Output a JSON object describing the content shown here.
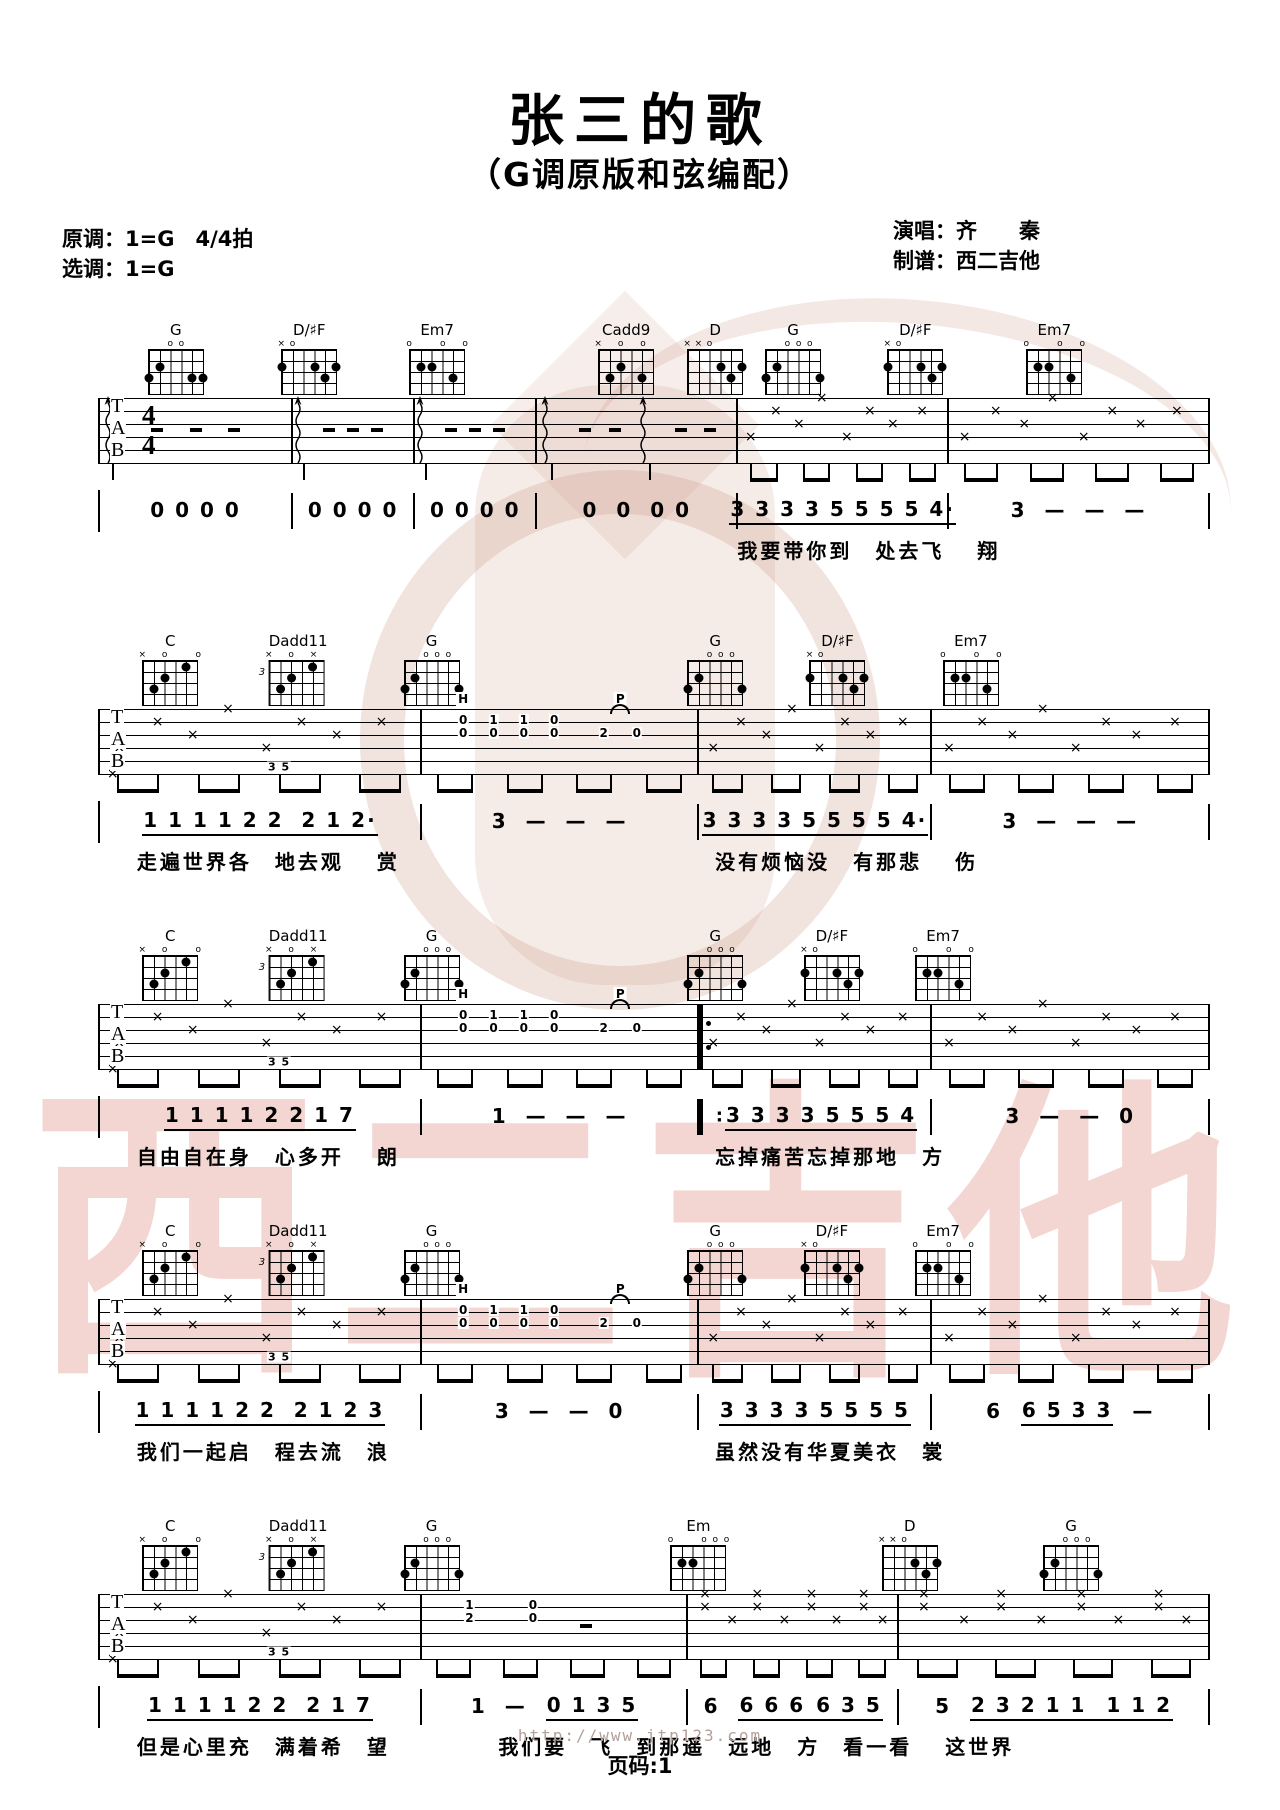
{
  "page": {
    "title": "张三的歌",
    "subtitle": "（G调原版和弦编配）"
  },
  "meta": {
    "original_key": "原调：1=G",
    "time_signature_label": "4/4拍",
    "time_signature": "4/4",
    "selected_key": "选调：1=G",
    "singer": "演唱：齐　　秦",
    "tabber": "制谱：西二吉他"
  },
  "watermark": {
    "text": "西二吉他"
  },
  "footer": {
    "url": "http://www.jtp123.com",
    "page_label": "页码:1"
  },
  "licks": {
    "hammer_label": "H",
    "pull_label": "P",
    "top_row": [
      "0",
      "1",
      "1",
      "0"
    ],
    "mid_row": [
      "0",
      "0",
      "0",
      "0"
    ],
    "pull_notes": [
      "2",
      "0"
    ],
    "bass_run": "3 5",
    "box_rows": [
      [
        "1",
        "0"
      ],
      [
        "2",
        "0"
      ]
    ]
  },
  "chord_shapes": {
    "G_a": {
      "name": "G",
      "top": [
        "",
        "",
        "o",
        "o",
        "",
        ""
      ],
      "dots": [
        [
          0,
          3
        ],
        [
          1,
          2
        ],
        [
          4,
          3
        ],
        [
          5,
          3
        ]
      ]
    },
    "G_b": {
      "name": "G",
      "top": [
        "",
        "",
        "o",
        "o",
        "o",
        ""
      ],
      "dots": [
        [
          0,
          3
        ],
        [
          1,
          2
        ],
        [
          5,
          3
        ]
      ]
    },
    "DsF": {
      "name": "D/♯F",
      "top": [
        "×",
        "o",
        "",
        "",
        "",
        ""
      ],
      "dots": [
        [
          0,
          2
        ],
        [
          3,
          2
        ],
        [
          4,
          3
        ],
        [
          5,
          2
        ]
      ]
    },
    "Em7": {
      "name": "Em7",
      "top": [
        "o",
        "",
        "",
        "o",
        "",
        "o"
      ],
      "dots": [
        [
          1,
          2
        ],
        [
          2,
          2
        ],
        [
          4,
          3
        ]
      ]
    },
    "Cadd9": {
      "name": "Cadd9",
      "top": [
        "×",
        "",
        "o",
        "",
        "o",
        ""
      ],
      "dots": [
        [
          1,
          3
        ],
        [
          2,
          2
        ],
        [
          4,
          3
        ]
      ]
    },
    "D": {
      "name": "D",
      "top": [
        "×",
        "×",
        "o",
        "",
        "",
        ""
      ],
      "dots": [
        [
          3,
          2
        ],
        [
          4,
          3
        ],
        [
          5,
          2
        ]
      ]
    },
    "C": {
      "name": "C",
      "top": [
        "×",
        "",
        "o",
        "",
        "",
        "o"
      ],
      "dots": [
        [
          1,
          3
        ],
        [
          2,
          2
        ],
        [
          4,
          1
        ]
      ]
    },
    "Dadd11": {
      "name": "Dadd11",
      "top": [
        "×",
        "",
        "o",
        "",
        "×",
        ""
      ],
      "dots": [
        [
          1,
          3
        ],
        [
          2,
          2
        ],
        [
          4,
          1
        ]
      ],
      "fret": "3"
    },
    "Em": {
      "name": "Em",
      "top": [
        "o",
        "",
        "",
        "o",
        "o",
        "o"
      ],
      "dots": [
        [
          1,
          2
        ],
        [
          2,
          2
        ]
      ]
    }
  },
  "systems": [
    {
      "ts": true,
      "chords": [
        {
          "s": "G_a",
          "x": 7
        },
        {
          "s": "DsF",
          "x": 19
        },
        {
          "s": "Em7",
          "x": 30.5
        },
        {
          "s": "Cadd9",
          "x": 47.5
        },
        {
          "s": "D",
          "x": 55.5
        },
        {
          "s": "G_b",
          "x": 62.5
        },
        {
          "s": "DsF",
          "x": 73.5
        },
        {
          "s": "Em7",
          "x": 86
        }
      ],
      "measures": [
        {
          "w": 17.4,
          "k": "strum"
        },
        {
          "w": 11,
          "k": "strum"
        },
        {
          "w": 11,
          "k": "strum"
        },
        {
          "w": 18.1,
          "k": "strum2"
        },
        {
          "w": 19,
          "k": "x"
        },
        {
          "w": 23.5,
          "k": "x"
        }
      ],
      "jianpu": [
        {
          "w": 17.4,
          "seg": [
            {
              "t": "0 0 0 0",
              "u": false
            }
          ]
        },
        {
          "w": 11,
          "seg": [
            {
              "t": "0 0 0 0",
              "u": false
            }
          ]
        },
        {
          "w": 11,
          "seg": [
            {
              "t": "0 0 0 0",
              "u": false
            }
          ]
        },
        {
          "w": 18.1,
          "seg": [
            {
              "t": "0  0  0 0",
              "u": false
            }
          ]
        },
        {
          "w": 19,
          "seg": [
            {
              "t": "3 3 3 3 5 5 5 5 4·",
              "u": true
            }
          ]
        },
        {
          "w": 23.5,
          "seg": [
            {
              "t": "3  —  —  —",
              "u": false
            }
          ]
        }
      ],
      "lyrics": [
        {
          "x": 57.5,
          "t": "我要带你到　处去飞　 翔"
        }
      ]
    },
    {
      "chords": [
        {
          "s": "C",
          "x": 6.5
        },
        {
          "s": "Dadd11",
          "x": 18
        },
        {
          "s": "G_b",
          "x": 30
        },
        {
          "s": "G_b",
          "x": 55.5
        },
        {
          "s": "DsF",
          "x": 66.5
        },
        {
          "s": "Em7",
          "x": 78.5
        }
      ],
      "measures": [
        {
          "w": 29,
          "k": "x35"
        },
        {
          "w": 25,
          "k": "lick"
        },
        {
          "w": 21,
          "k": "x"
        },
        {
          "w": 25,
          "k": "x"
        }
      ],
      "jianpu": [
        {
          "w": 29,
          "seg": [
            {
              "t": "1 1 1 1 2 2  2 1 2·",
              "u": true
            }
          ]
        },
        {
          "w": 25,
          "seg": [
            {
              "t": "3  —  —  —",
              "u": false
            }
          ]
        },
        {
          "w": 21,
          "seg": [
            {
              "t": "3 3 3 3 5 5 5 5 4·",
              "u": true
            }
          ]
        },
        {
          "w": 25,
          "seg": [
            {
              "t": "3  —  —  —",
              "u": false
            }
          ]
        }
      ],
      "lyrics": [
        {
          "x": 3.5,
          "t": "走遍世界各　地去观　 赏"
        },
        {
          "x": 55.5,
          "t": "没有烦恼没　有那悲　 伤"
        }
      ]
    },
    {
      "chords": [
        {
          "s": "C",
          "x": 6.5
        },
        {
          "s": "Dadd11",
          "x": 18
        },
        {
          "s": "G_b",
          "x": 30
        },
        {
          "s": "G_b",
          "x": 55.5
        },
        {
          "s": "DsF",
          "x": 66
        },
        {
          "s": "Em7",
          "x": 76
        }
      ],
      "measures": [
        {
          "w": 29,
          "k": "x35"
        },
        {
          "w": 25,
          "k": "lick"
        },
        {
          "w": 21,
          "k": "x",
          "rep": true
        },
        {
          "w": 25,
          "k": "x"
        }
      ],
      "jianpu": [
        {
          "w": 29,
          "seg": [
            {
              "t": "1 1 1 1 2 2 1 7",
              "u": true
            }
          ]
        },
        {
          "w": 25,
          "seg": [
            {
              "t": "1  —  —  —",
              "u": false
            }
          ]
        },
        {
          "w": 21,
          "rep": true,
          "seg": [
            {
              "t": "3 3 3 3 5 5 5 4",
              "u": true
            }
          ]
        },
        {
          "w": 25,
          "seg": [
            {
              "t": "3  —  —  0",
              "u": false
            }
          ]
        }
      ],
      "lyrics": [
        {
          "x": 3.5,
          "t": "自由自在身　心多开　 朗"
        },
        {
          "x": 55.5,
          "t": "忘掉痛苦忘掉那地　方"
        }
      ]
    },
    {
      "chords": [
        {
          "s": "C",
          "x": 6.5
        },
        {
          "s": "Dadd11",
          "x": 18
        },
        {
          "s": "G_b",
          "x": 30
        },
        {
          "s": "G_b",
          "x": 55.5
        },
        {
          "s": "DsF",
          "x": 66
        },
        {
          "s": "Em7",
          "x": 76
        }
      ],
      "measures": [
        {
          "w": 29,
          "k": "x35"
        },
        {
          "w": 25,
          "k": "lick"
        },
        {
          "w": 21,
          "k": "x"
        },
        {
          "w": 25,
          "k": "x"
        }
      ],
      "jianpu": [
        {
          "w": 29,
          "seg": [
            {
              "t": "1 1 1 1 2 2  2 1 2 3",
              "u": true
            }
          ]
        },
        {
          "w": 25,
          "seg": [
            {
              "t": "3  —  —  0",
              "u": false
            }
          ]
        },
        {
          "w": 21,
          "seg": [
            {
              "t": "3 3 3 3 5 5 5 5",
              "u": true
            }
          ]
        },
        {
          "w": 25,
          "seg": [
            {
              "t": "6  ",
              "u": false
            },
            {
              "t": "6 5 3 3",
              "u": true
            },
            {
              "t": "  —",
              "u": false
            }
          ]
        }
      ],
      "lyrics": [
        {
          "x": 3.5,
          "t": "我们一起启　程去流　浪"
        },
        {
          "x": 55.5,
          "t": "虽然没有华夏美衣　裳"
        }
      ]
    },
    {
      "chords": [
        {
          "s": "C",
          "x": 6.5
        },
        {
          "s": "Dadd11",
          "x": 18
        },
        {
          "s": "G_b",
          "x": 30
        },
        {
          "s": "Em",
          "x": 54
        },
        {
          "s": "D",
          "x": 73
        },
        {
          "s": "G_b",
          "x": 87.5
        }
      ],
      "measures": [
        {
          "w": 29,
          "k": "x35"
        },
        {
          "w": 24,
          "k": "lick5"
        },
        {
          "w": 19,
          "k": "x2"
        },
        {
          "w": 28,
          "k": "x2"
        }
      ],
      "jianpu": [
        {
          "w": 29,
          "seg": [
            {
              "t": "1 1 1 1 2 2  2 1 7",
              "u": true
            }
          ]
        },
        {
          "w": 24,
          "seg": [
            {
              "t": "1  —  ",
              "u": false
            },
            {
              "t": "0 1 3 5",
              "u": true
            }
          ]
        },
        {
          "w": 19,
          "seg": [
            {
              "t": "6  ",
              "u": false
            },
            {
              "t": "6 6 6",
              "u": true
            },
            {
              "t": " 6 3 5",
              "u": true
            }
          ]
        },
        {
          "w": 28,
          "seg": [
            {
              "t": "5  ",
              "u": false
            },
            {
              "t": "2 3 2 1 1",
              "u": true
            },
            {
              "t": "  1 1 2",
              "u": true
            }
          ]
        }
      ],
      "lyrics": [
        {
          "x": 3.5,
          "t": "但是心里充　满着希　望"
        },
        {
          "x": 36,
          "t": "我们要　飞　到那遥　远地　方　看一看　 这世界"
        }
      ]
    }
  ]
}
